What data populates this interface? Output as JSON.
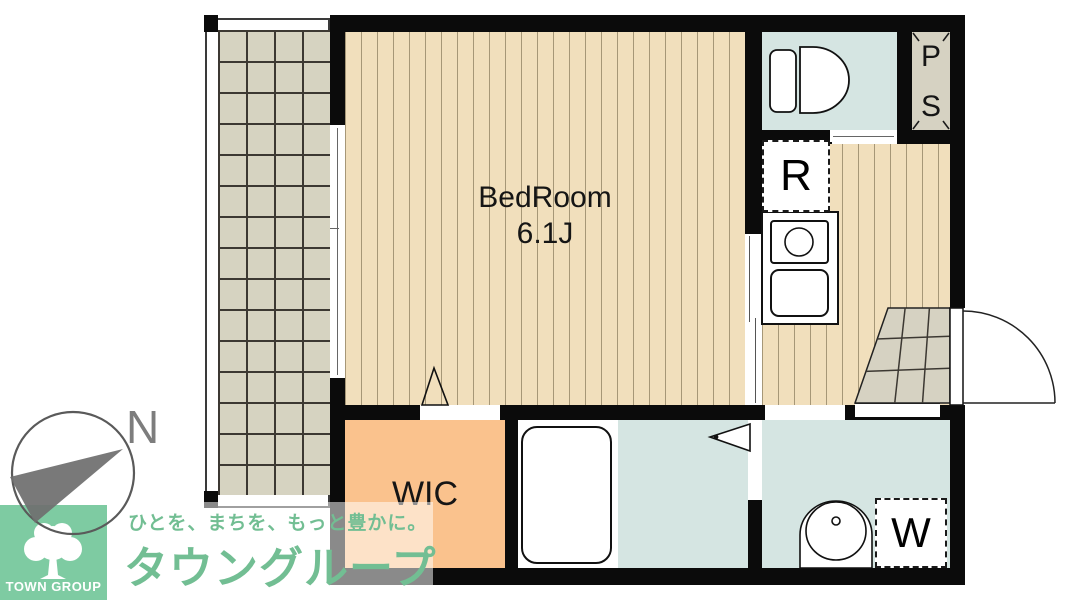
{
  "floorplan": {
    "rooms": {
      "bedroom": {
        "label": "BedRoom",
        "area": "6.1J"
      },
      "wic": {
        "label": "WIC"
      },
      "pipe_space": {
        "letters": [
          "P",
          "S"
        ]
      },
      "refrigerator_space": {
        "label": "R"
      },
      "washing_machine_space": {
        "label": "W"
      }
    },
    "compass": {
      "north_label": "N"
    }
  },
  "branding": {
    "tagline": "ひとを、まちを、もっと豊かに。",
    "company_name": "タウングループ",
    "badge_text": "TOWN GROUP"
  },
  "colors": {
    "floor_wood": "#F1DFBC",
    "balcony_tile": "#D6D3C1",
    "wet_area": "#D5E5E2",
    "wic_orange": "#FAC28D",
    "entrance_tile": "#D6D2C2",
    "wall": "#0B0B0B",
    "brand_green": "#72BE93",
    "badge_green": "#7ECBA2"
  }
}
